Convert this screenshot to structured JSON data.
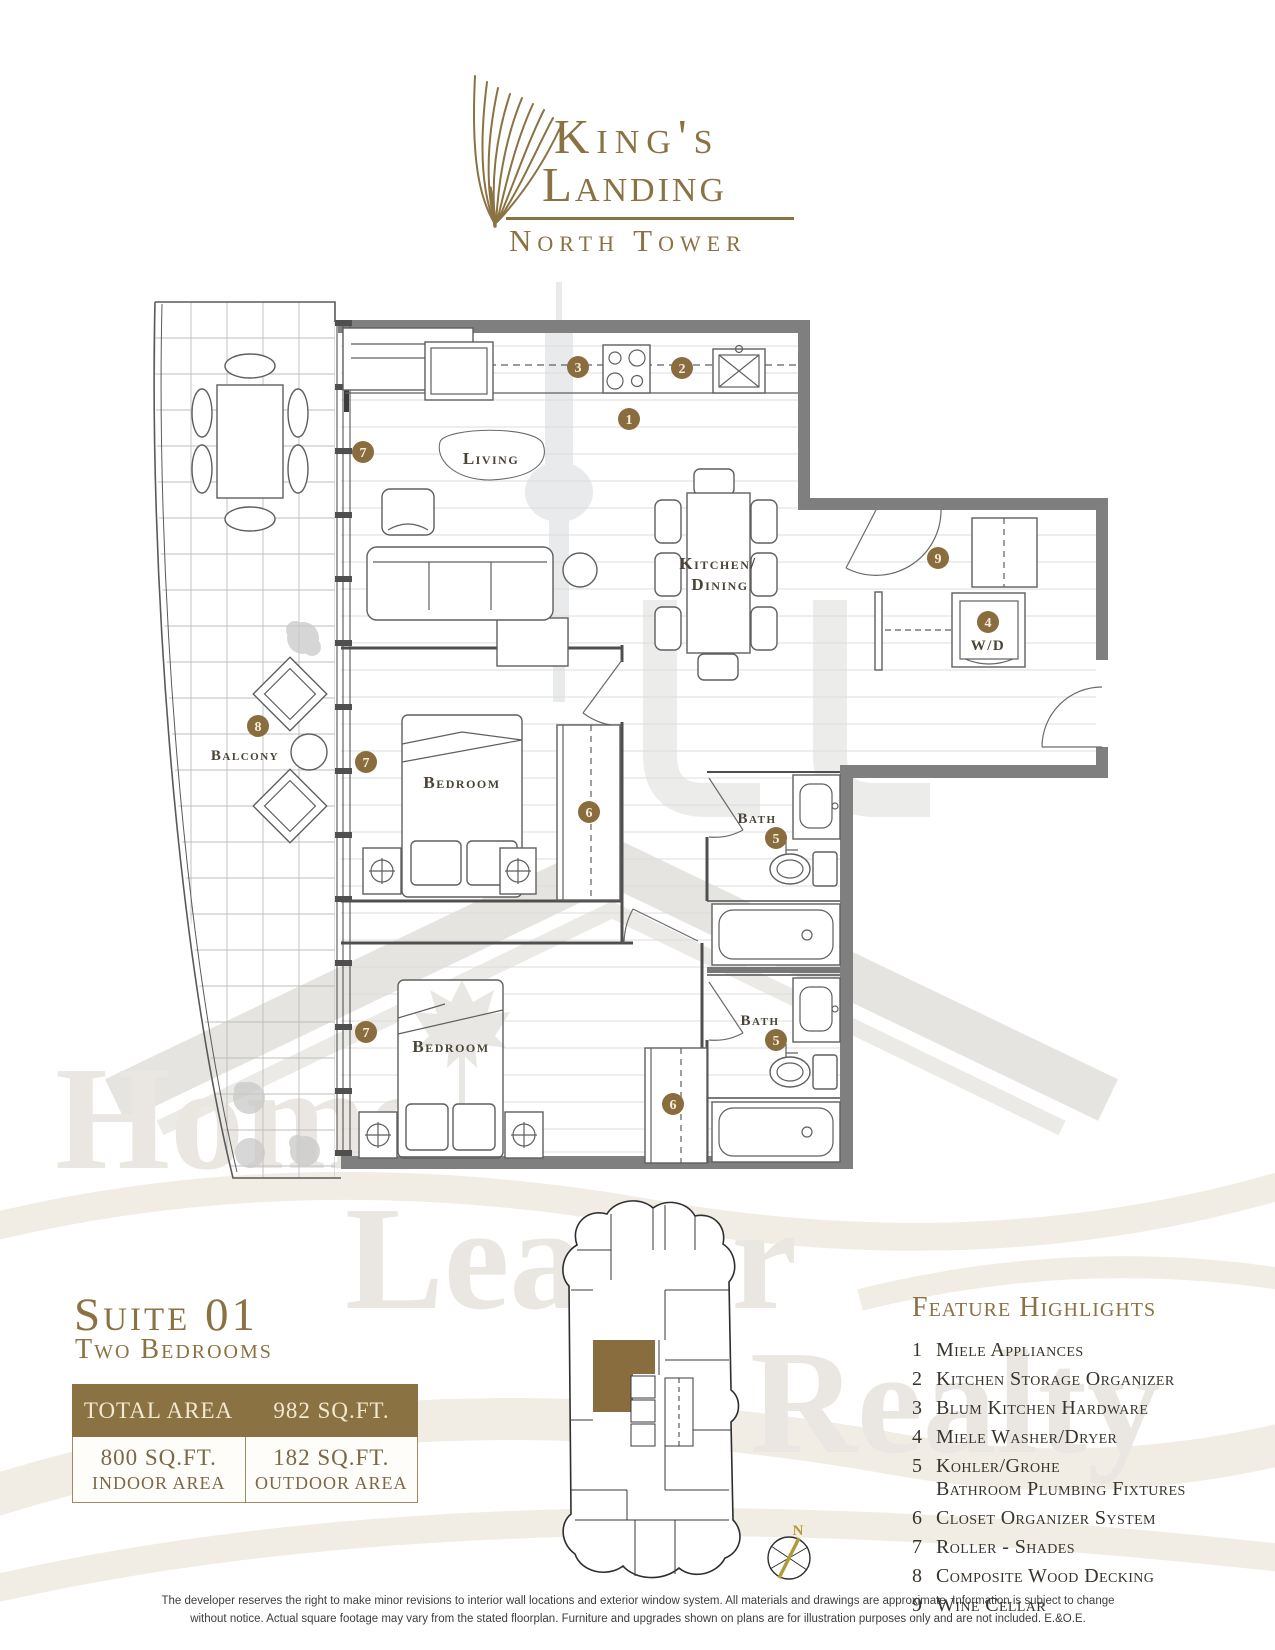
{
  "logo": {
    "name_line1": "King's",
    "name_line2": "Landing",
    "subtitle": "North Tower"
  },
  "plan": {
    "rooms": {
      "living": "Living",
      "kitchen_line1": "Kitchen/",
      "kitchen_line2": "Dining",
      "bedroom1": "Bedroom",
      "bedroom2": "Bedroom",
      "bath1": "Bath",
      "bath2": "Bath",
      "balcony": "Balcony",
      "washer_dryer": "W/D"
    },
    "markers": {
      "appliances": "1",
      "storage": "2",
      "hardware": "3",
      "washer": "4",
      "bath1": "5",
      "bath2": "5",
      "closet1": "6",
      "closet2": "6",
      "window_living": "7",
      "window_bed1": "7",
      "window_bed2": "7",
      "decking": "8",
      "wine": "9"
    }
  },
  "suite": {
    "title": "Suite 01",
    "subtitle": "Two Bedrooms",
    "total_label": "TOTAL AREA",
    "total_value": "982 SQ.FT.",
    "indoor_value": "800 SQ.FT.",
    "indoor_label": "INDOOR AREA",
    "outdoor_value": "182 SQ.FT.",
    "outdoor_label": "OUTDOOR AREA"
  },
  "features": {
    "title": "Feature Highlights",
    "items": [
      {
        "num": "1",
        "text": "Miele Appliances"
      },
      {
        "num": "2",
        "text": "Kitchen Storage Organizer"
      },
      {
        "num": "3",
        "text": "Blum Kitchen Hardware"
      },
      {
        "num": "4",
        "text": "Miele Washer/Dryer"
      },
      {
        "num": "5",
        "text": "Kohler/Grohe",
        "text2": "Bathroom Plumbing Fixtures"
      },
      {
        "num": "6",
        "text": "Closet Organizer System"
      },
      {
        "num": "7",
        "text": "Roller - Shades"
      },
      {
        "num": "8",
        "text": "Composite Wood Decking"
      },
      {
        "num": "9",
        "text": "Wine Cellar"
      }
    ]
  },
  "compass": {
    "north": "N"
  },
  "watermark": {
    "word1": "Home",
    "word2": "Leader",
    "word3": "Realty"
  },
  "disclaimer": {
    "line1": "The developer reserves the right to make minor revisions to interior wall locations and exterior window system. All materials and drawings are approximate. Information is subject to change",
    "line2": "without notice. Actual square footage may vary from the stated floorplan. Furniture and upgrades shown on plans are for illustration purposes only and are not included. E.&O.E."
  },
  "colors": {
    "gold": "#8a7243",
    "marker_fill": "#8a6d3e",
    "wall_gray": "#7f7f7f",
    "highlight_suite": "#8a6d3e"
  }
}
